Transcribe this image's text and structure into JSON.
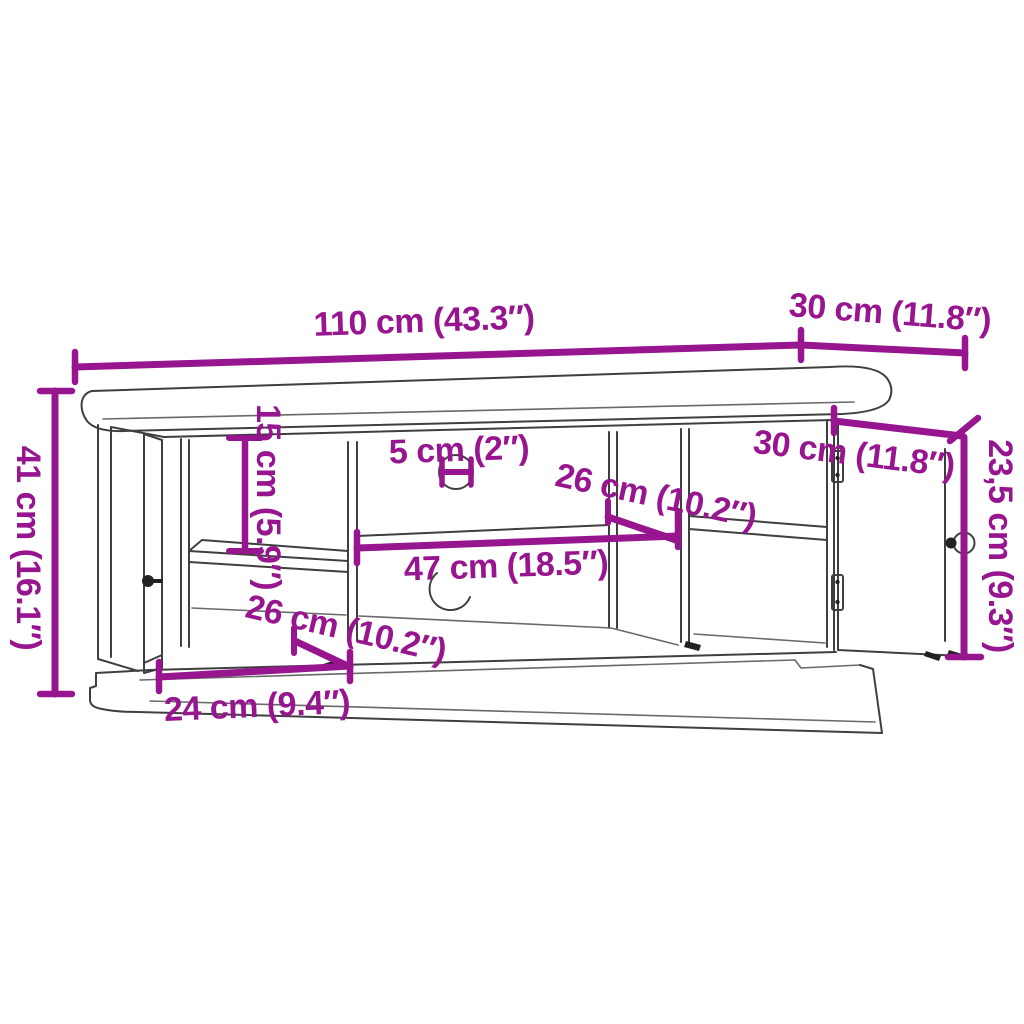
{
  "palette": {
    "dimension_color": "#97158F",
    "outline_color": "#3F3F3F",
    "background": "#FFFFFF"
  },
  "dimension_labels": {
    "top_width": "110 cm (43.3″)",
    "top_depth": "30 cm (11.8″)",
    "overall_height": "41 cm (16.1″)",
    "shelf_opening_height": "15 cm (5.9″)",
    "cable_hole_diameter": "5 cm (2″)",
    "upper_shelf_depth": "26 cm (10.2″)",
    "middle_opening_width": "47 cm (18.5″)",
    "open_door_depth": "30 cm (11.8″)",
    "open_door_height": "23,5 cm (9.3″)",
    "lower_compartment_depth": "26 cm (10.2″)",
    "left_door_width": "24 cm (9.4″)"
  }
}
